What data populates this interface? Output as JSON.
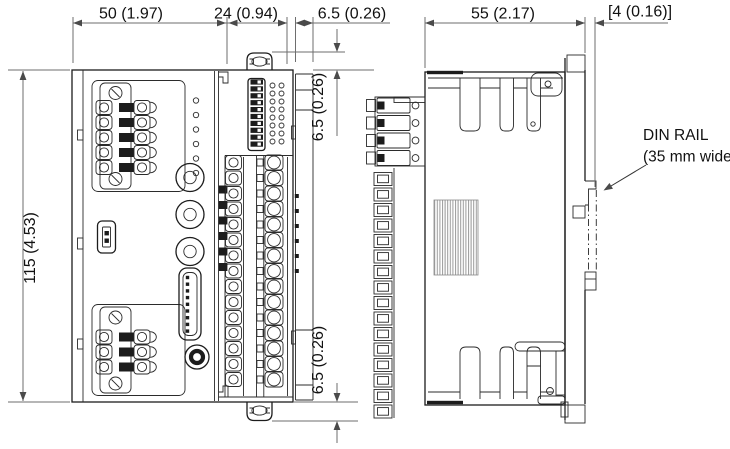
{
  "drawing": {
    "dimensions": {
      "front_width": "50 (1.97)",
      "mid_width": "24 (0.94)",
      "flange_width": "6.5 (0.26)",
      "side_depth": "55 (2.17)",
      "rail_offset": "[4 (0.16)]",
      "height": "115 (4.53)",
      "top_tab": "6.5 (0.26)",
      "bottom_tab": "6.5 (0.26)"
    },
    "labels": {
      "din_rail_line1": "DIN RAIL",
      "din_rail_line2": "(35 mm wide)"
    },
    "colors": {
      "background": "#ffffff",
      "part_line": "#1c1c1c",
      "dimension_line": "#6e6e6e",
      "text": "#111111",
      "hatch": "#9a9a9a"
    }
  }
}
